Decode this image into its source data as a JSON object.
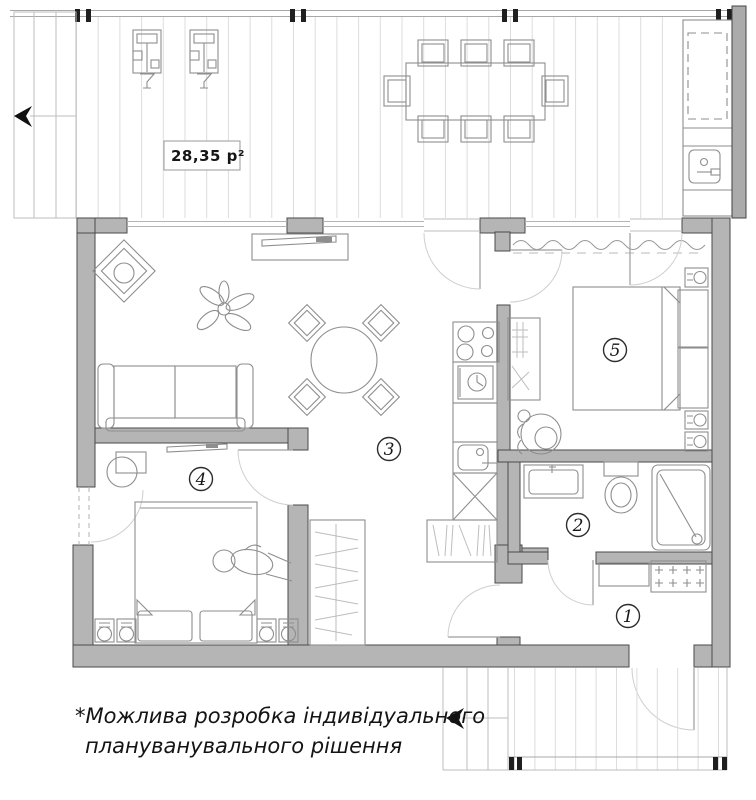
{
  "terrace": {
    "area_label": "28,35 р²"
  },
  "room_labels": [
    "1",
    "2",
    "3",
    "4",
    "5"
  ],
  "note": {
    "line1": "*Можлива розробка індивідуального",
    "line2": "плануванувального рішення"
  },
  "colors": {
    "wall_fill": "#b5b5b5",
    "wall_stroke": "#4a4a4a",
    "furniture_line": "#8e8e8e",
    "deck_line": "#dcdcdc",
    "text": "#161616",
    "railing_post": "#1f1f1f",
    "background": "#ffffff"
  }
}
